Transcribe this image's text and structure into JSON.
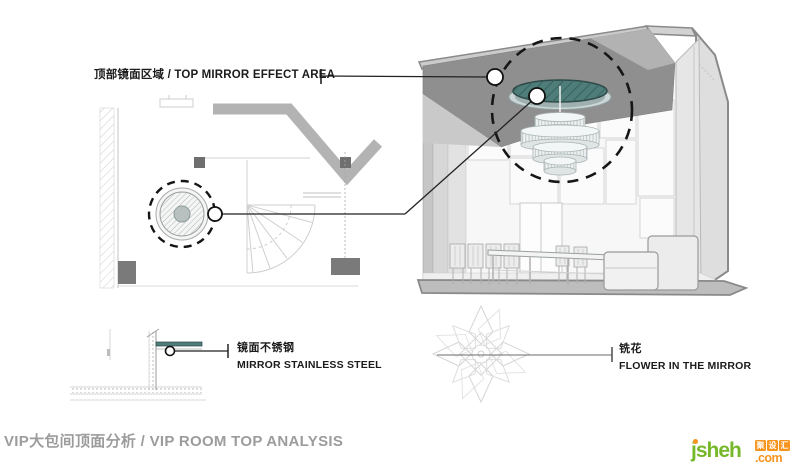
{
  "callouts": {
    "top_mirror": {
      "label": "顶部镜面区域 / TOP MIRROR EFFECT AREA"
    },
    "stainless": {
      "zh": "镜面不锈钢",
      "en": "MIRROR STAINLESS STEEL"
    },
    "flower": {
      "zh": "铣花",
      "en": "FLOWER IN THE MIRROR"
    }
  },
  "footer": {
    "title": "VIP大包间顶面分析 / VIP ROOM TOP ANALYSIS"
  },
  "logo": {
    "brand": "jsheh",
    "tld": ".com",
    "badge": "聚设汇",
    "badge_chars": [
      "聚",
      "设",
      "汇"
    ]
  },
  "colors": {
    "teal": "#4E7D7A",
    "logo_green": "#76B82A",
    "logo_orange": "#F7941E",
    "title_gray": "#9C9C9C",
    "label_black": "#1B1B1B"
  }
}
